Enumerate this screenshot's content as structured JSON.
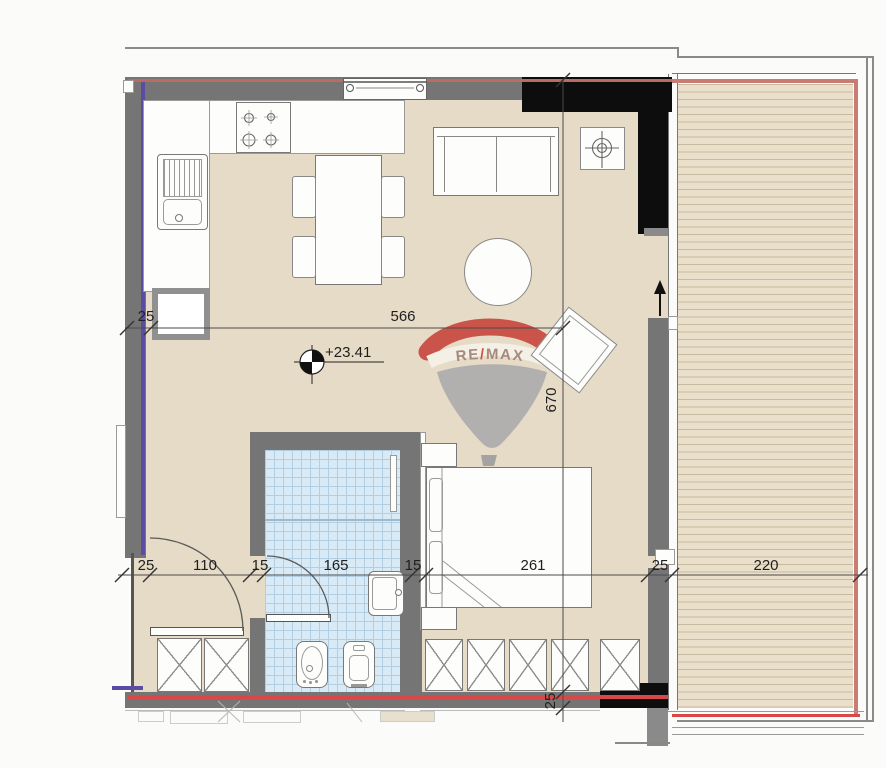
{
  "floorplan": {
    "watermark": {
      "part_re": "RE",
      "part_slash": "/",
      "part_max": "MAX"
    },
    "elevation": {
      "value": "+23.41"
    },
    "dims": {
      "top_wall": "25",
      "top_span": "566",
      "depth_span": "670",
      "bottom": [
        "25",
        "110",
        "15",
        "165",
        "15",
        "261",
        "25",
        "220"
      ],
      "bottom_wall": "25"
    },
    "colors": {
      "floor": "#e6dbc6",
      "deck": "#e9dfcb",
      "deck_line": "#c7b99e",
      "tile": "#d8eaf6",
      "tile_line": "#b3cee0",
      "wall": "#757575",
      "black_wall": "#0d0d0d",
      "red_line": "#d94848",
      "purple_line": "#5b4ba4",
      "watermark_red": "#c8463c",
      "watermark_gray": "#acacac"
    }
  }
}
